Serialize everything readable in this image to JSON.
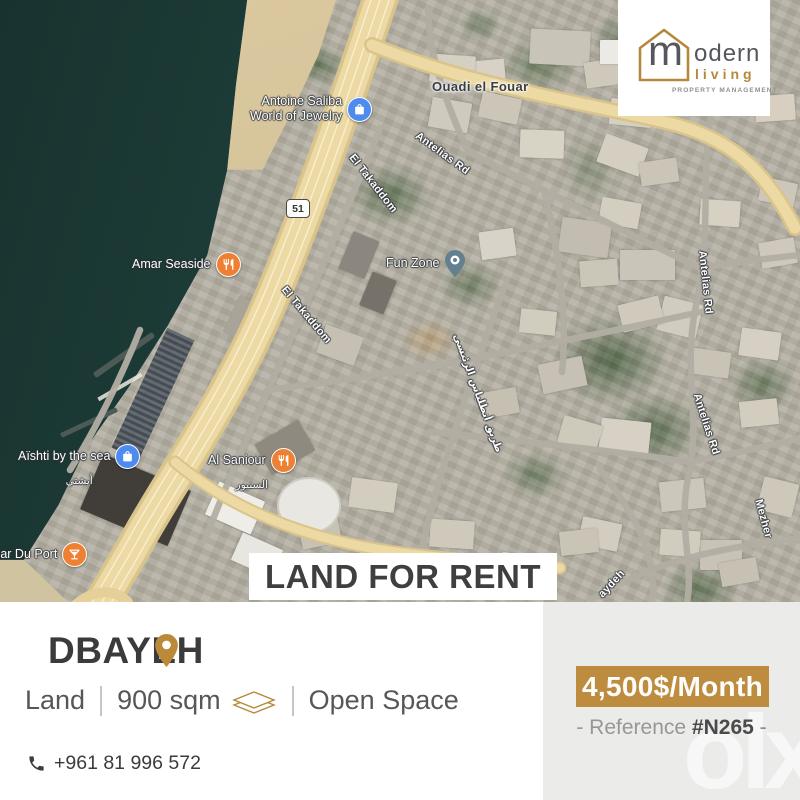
{
  "logo": {
    "letter": "m",
    "word_rest": "odern",
    "word2": "living",
    "tagline": "PROPERTY MANAGEMENT"
  },
  "map": {
    "locality": "Ouadi el Fouar",
    "shield": "51",
    "roads": {
      "antelias_top": "Antelias Rd",
      "antelias_mid": "Antelias Rd",
      "antelias_low": "Antelias Rd",
      "takaddom_1": "El Takaddom",
      "takaddom_2": "El Takaddom",
      "mezher": "Mezher",
      "zaydeh": "aydeh",
      "main_arabic": "طريق أنطلياس الرئيسي"
    },
    "pois": {
      "jewelry_line1": "Antoine Saliba",
      "jewelry_line2": "World of Jewelry",
      "amar": "Amar Seaside",
      "funzone": "Fun Zone",
      "aishti": "Aïshti by the sea",
      "aishti_arabic": "أيشتي",
      "saniour": "Al Saniour",
      "saniour_arabic": "السنيور",
      "bar": "Bar Du Port"
    }
  },
  "banner": "LAND FOR RENT",
  "listing": {
    "location": "DBAYEH",
    "type": "Land",
    "area": "900 sqm",
    "feature": "Open Space",
    "phone": "+961 81 996 572"
  },
  "price": {
    "amount": "4,500$/Month",
    "ref_prefix": "- Reference ",
    "ref_number": "#N265",
    "ref_suffix": " -"
  },
  "watermark": "olx",
  "colors": {
    "gold": "#bd8c3e",
    "logo_gold": "#b5893a",
    "dark_text": "#3b3b3b",
    "panel_gray": "#ebebe9",
    "poi_blue": "#4d8bf0",
    "poi_orange": "#ef8033"
  }
}
